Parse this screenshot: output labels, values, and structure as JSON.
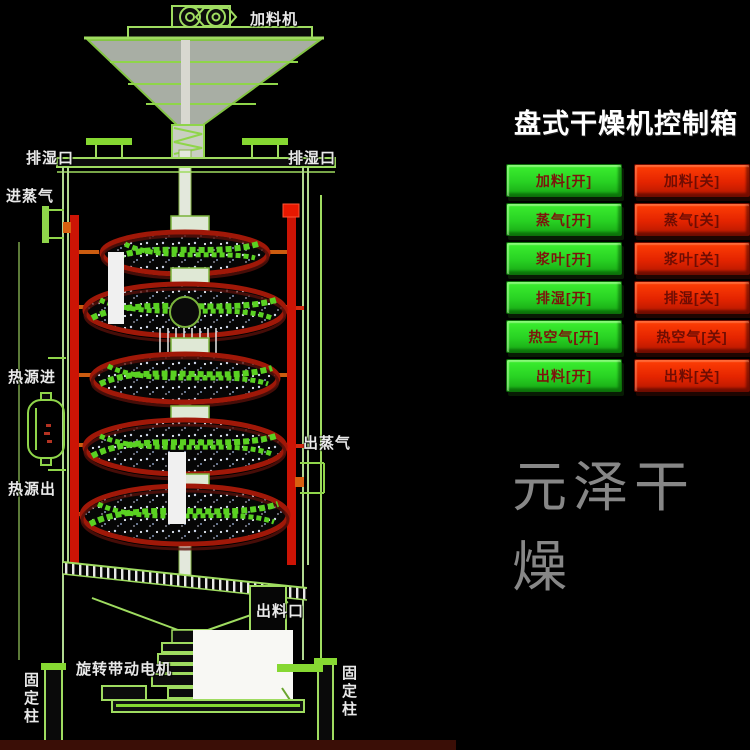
{
  "panel": {
    "title": "盘式干燥机控制箱",
    "rows": [
      {
        "on": "加料[开]",
        "off": "加料[关]"
      },
      {
        "on": "蒸气[开]",
        "off": "蒸气[关]"
      },
      {
        "on": "浆叶[开]",
        "off": "浆叶[关]"
      },
      {
        "on": "排湿[开]",
        "off": "排湿[关]"
      },
      {
        "on": "热空气[开]",
        "off": "热空气[关]"
      },
      {
        "on": "出料[开]",
        "off": "出料[关]"
      }
    ],
    "on_color": "#28d123",
    "off_color": "#e42400"
  },
  "watermark": "元泽干燥",
  "diagram": {
    "labels": {
      "feeder": "加料机",
      "vent_left": "排湿口",
      "vent_right": "排湿口",
      "steam_in": "进蒸气",
      "heat_in": "热源进",
      "heat_out": "热源出",
      "steam_out": "出蒸气",
      "discharge": "出料口",
      "motor": "旋转带动电机",
      "column_left": "固定柱",
      "column_right": "固定柱"
    },
    "line_color": "#9fdc60",
    "pipe_color": "#cc1405",
    "disc_rim_color": "#a01808",
    "paddle_color": "#5ad122"
  }
}
